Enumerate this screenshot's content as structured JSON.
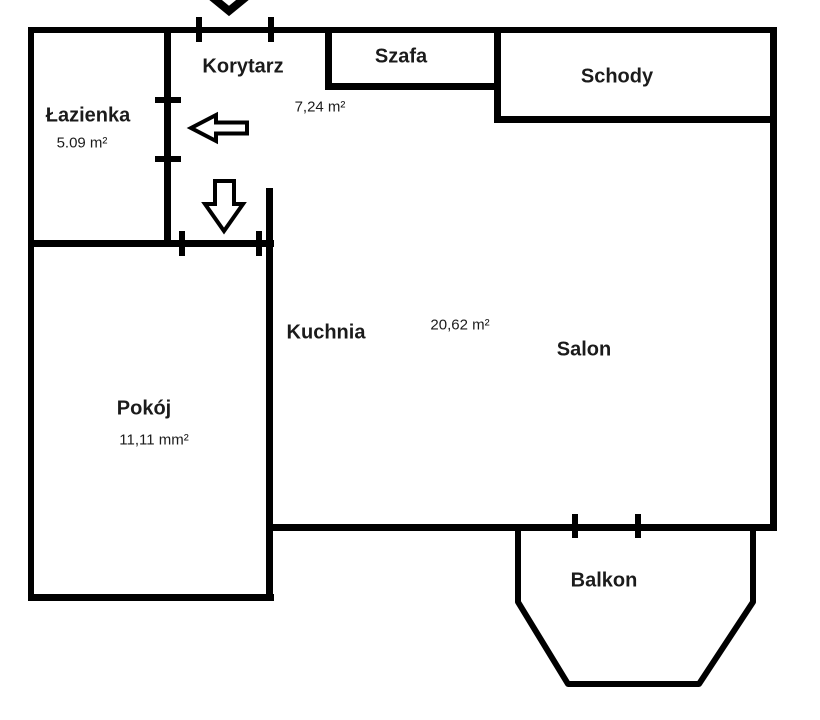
{
  "plan": {
    "background_color": "#ffffff",
    "wall_color": "#000000",
    "text_color": "#1b1b1b",
    "rooms": [
      {
        "id": "lazienka",
        "label": "Łazienka",
        "area": "5.09 m²"
      },
      {
        "id": "korytarz",
        "label": "Korytarz",
        "area": "7,24 m²"
      },
      {
        "id": "szafa",
        "label": "Szafa"
      },
      {
        "id": "schody",
        "label": "Schody"
      },
      {
        "id": "kuchnia",
        "label": "Kuchnia"
      },
      {
        "id": "salon",
        "label": "Salon",
        "area": "20,62 m²"
      },
      {
        "id": "pokoj",
        "label": "Pokój",
        "area": "11,11 mm²"
      },
      {
        "id": "balkon",
        "label": "Balkon"
      }
    ],
    "icons": [
      "entrance-down-chevron-icon",
      "hollow-left-arrow-icon",
      "hollow-down-arrow-icon"
    ]
  }
}
